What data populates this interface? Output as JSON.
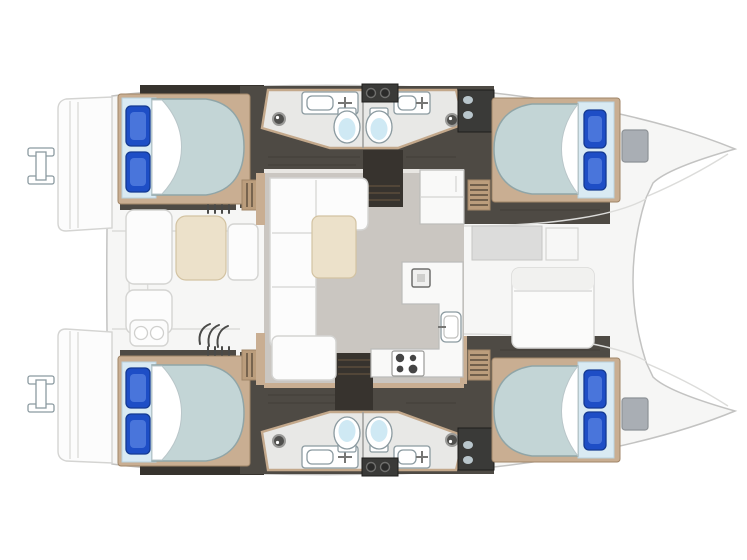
{
  "meta": {
    "title": "Catamaran deck and accommodation floor plan, top-down view, bow to the right",
    "type": "boat-floor-plan",
    "orientation": {
      "bow": "right",
      "stern": "left"
    },
    "hull_count": 2
  },
  "accommodation": {
    "cabins": [
      {
        "id": "top-hull-aft-cabin",
        "berth": "double",
        "pillow_count": 2,
        "pillow_color": "blue"
      },
      {
        "id": "top-hull-forward-cabin",
        "berth": "double",
        "pillow_count": 2,
        "pillow_color": "blue"
      },
      {
        "id": "bottom-hull-aft-cabin",
        "berth": "double",
        "pillow_count": 2,
        "pillow_color": "blue"
      },
      {
        "id": "bottom-hull-forward-cabin",
        "berth": "double",
        "pillow_count": 2,
        "pillow_color": "blue"
      }
    ],
    "bathrooms": [
      {
        "id": "top-hull-aft-bathroom",
        "fixtures": [
          "toilet",
          "sink",
          "shower"
        ]
      },
      {
        "id": "top-hull-forward-bathroom",
        "fixtures": [
          "toilet",
          "sink",
          "shower"
        ]
      },
      {
        "id": "bottom-hull-aft-bathroom",
        "fixtures": [
          "toilet",
          "sink",
          "shower"
        ]
      },
      {
        "id": "bottom-hull-forward-bathroom",
        "fixtures": [
          "toilet",
          "sink",
          "shower"
        ]
      }
    ],
    "salon": {
      "furniture": [
        "L-shaped sofa",
        "coffee table",
        "ottoman seat",
        "companionway steps"
      ]
    },
    "galley": {
      "equipment": [
        "refrigerator unit",
        "L-shaped counter",
        "sink",
        "four-burner stove"
      ]
    },
    "cockpit": {
      "furniture": [
        "cockpit table",
        "bench seats",
        "twin-basin unit"
      ]
    },
    "foredeck": {
      "features": [
        "sun pad lounger",
        "deck locker",
        "anchor locker recess"
      ]
    },
    "stern": {
      "features": [
        "swim platform steps",
        "boarding ladder"
      ]
    },
    "bows": {
      "features": [
        "storage hatch"
      ]
    }
  },
  "colors": {
    "pageBg": "#ffffff",
    "hullFill": "#f6f6f5",
    "hullStroke": "#c3c3c2",
    "deckLine": "#dcdcda",
    "darkFloor": "#4e4a44",
    "darkFloorDeep": "#37332e",
    "wood": "#c9ae92",
    "woodDark": "#a08568",
    "stepWood": "#bb9d7c",
    "stepLine": "#5b4c3c",
    "bathFloor": "#e8e8e6",
    "bathTrim": "#c3a88b",
    "mattress": "#c3d5d6",
    "mattressStroke": "#90a5a7",
    "headboard": "#d9eaf3",
    "pillow": "#1e4ec6",
    "pillowLight": "#6e96ec",
    "pillowStroke": "#143a92",
    "toiletWater": "#cfe9f4",
    "fixtureStroke": "#8b9aa0",
    "salonFloor": "#cac6c1",
    "table": "#ece1ca",
    "tableStroke": "#d3c3a2",
    "sofa": "#fcfcfc",
    "sofaStroke": "#d4d4d2",
    "counter": "#f9f9f8",
    "counterStroke": "#bcbcba",
    "burner": "#454545",
    "applianceDark": "#3a3a38",
    "applianceKnob": "#2b2b2a",
    "hatch": "#a9aeb4",
    "hatchStroke": "#8d9296",
    "insetGray": "#dcdcdb",
    "combStroke": "#4a4a48"
  }
}
